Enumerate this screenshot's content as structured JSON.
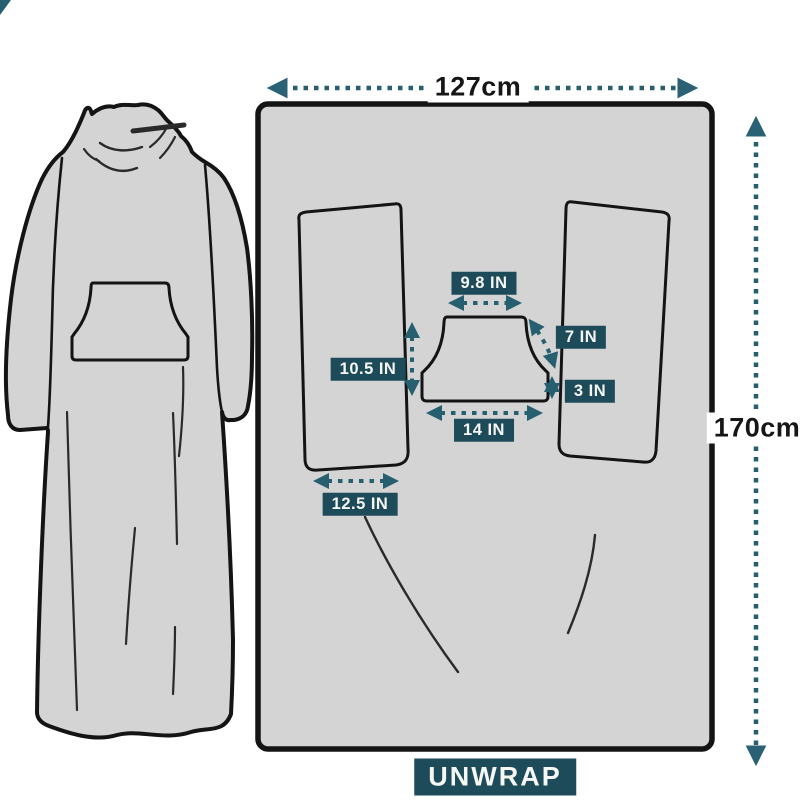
{
  "colors": {
    "teal_box": "#1d4b5a",
    "teal_arrow": "#265f70",
    "fabric_gray": "#d4d4d4",
    "outline_black": "#141414",
    "background": "#ffffff"
  },
  "measurements": {
    "overall_width": "127cm",
    "overall_height": "170cm",
    "pocket_top_width": "9.8 IN",
    "pocket_slant_height": "7 IN",
    "pocket_side_height": "3 IN",
    "sleeve_opening_height": "10.5 IN",
    "pocket_bottom_width": "14 IN",
    "sleeve_opening_width": "12.5 IN"
  },
  "badge": {
    "unwrap": "UNWRAP"
  }
}
